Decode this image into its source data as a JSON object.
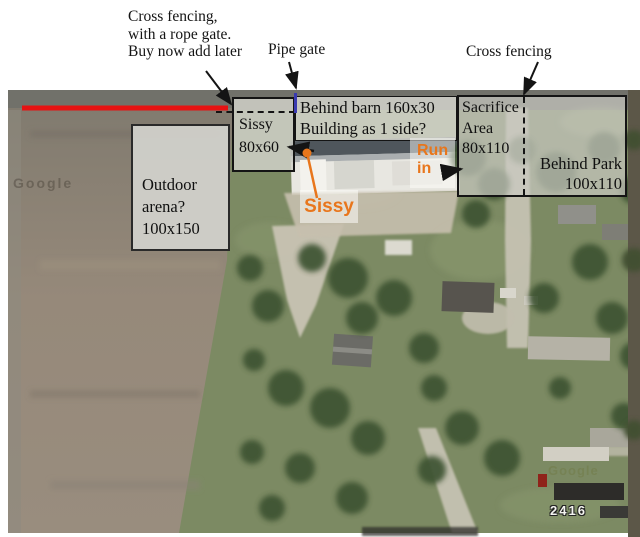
{
  "notes": {
    "cross_fencing_left_1": "Cross fencing,",
    "cross_fencing_left_2": "with a rope gate.",
    "cross_fencing_left_3": "Buy now add later",
    "pipe_gate": "Pipe gate",
    "cross_fencing_right": "Cross fencing"
  },
  "areas": {
    "sissy": {
      "name": "Sissy",
      "size": "80x60"
    },
    "behind_barn": {
      "line1": "Behind barn 160x30",
      "line2": "Building as 1 side?"
    },
    "sacrifice": {
      "name1": "Sacrifice",
      "name2": "Area",
      "size": "80x110"
    },
    "behind_park": {
      "name": "Behind Park",
      "size": "100x110"
    },
    "outdoor_arena": {
      "name1": "Outdoor",
      "name2": "arena?",
      "size": "100x150"
    }
  },
  "callouts": {
    "sissy": "Sissy",
    "run_in_1": "Run",
    "run_in_2": "in"
  },
  "map": {
    "house_number": "2416",
    "watermark": "Google",
    "watermark2": "Google"
  },
  "colors": {
    "red_fence_line": "#e61212",
    "pipe_gate_blue": "#3a3ab0",
    "callout_orange": "#e8761c",
    "annotation_box_fill": "#d0d0c8",
    "annotation_border": "#141414"
  }
}
